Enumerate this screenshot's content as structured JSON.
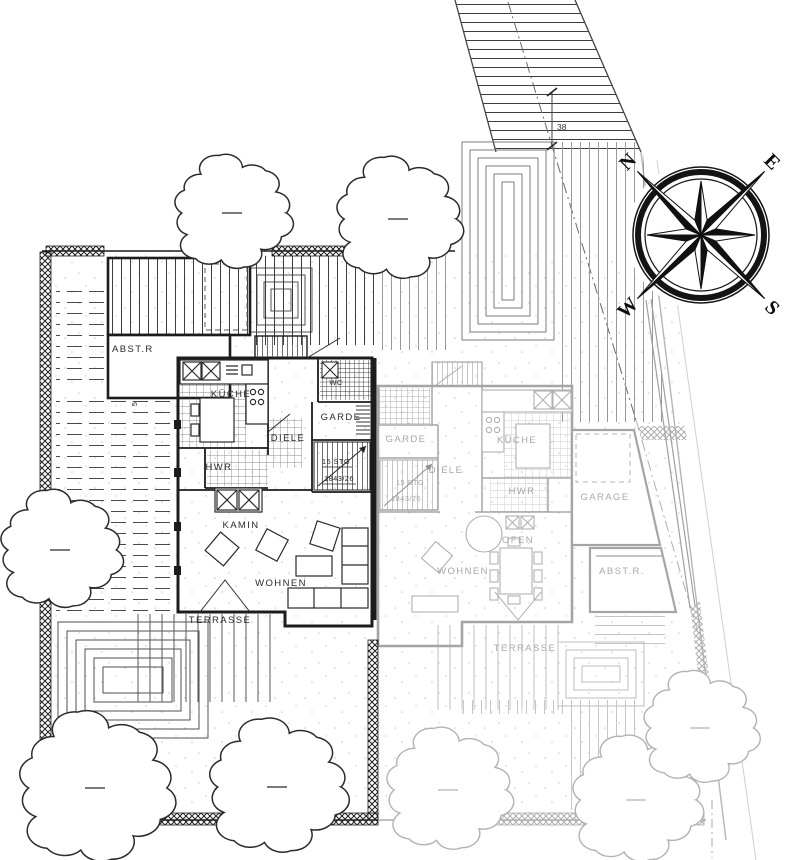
{
  "colors": {
    "ink": "#1c1c1c",
    "faded": "#a8a8a8",
    "paper": "#ffffff"
  },
  "compass": {
    "north": "N",
    "east": "E",
    "south": "S",
    "west": "W"
  },
  "dimension": {
    "offset": "38"
  },
  "left_house": {
    "abstellraum": "ABST.R",
    "kueche": "KÜCHE",
    "wc": "WC",
    "diele": "DIELE",
    "garderobe": "GARDE",
    "hwr": "HWR",
    "kamin": "KAMIN",
    "wohnen": "WOHNEN",
    "terrasse": "TERRASSE",
    "stair_count": "15 STG",
    "stair_dim": "1843/26",
    "entry_steps": "5"
  },
  "right_house": {
    "garderobe": "GARDE",
    "diele": "DIELE",
    "kueche": "KÜCHE",
    "hwr": "HWR",
    "ofen": "OFEN",
    "wohnen": "WOHNEN",
    "terrasse": "TERRASSE",
    "garage": "GARAGE",
    "abstellraum": "ABST.R.",
    "stair_count": "15 STG",
    "stair_dim": "1843/26"
  }
}
